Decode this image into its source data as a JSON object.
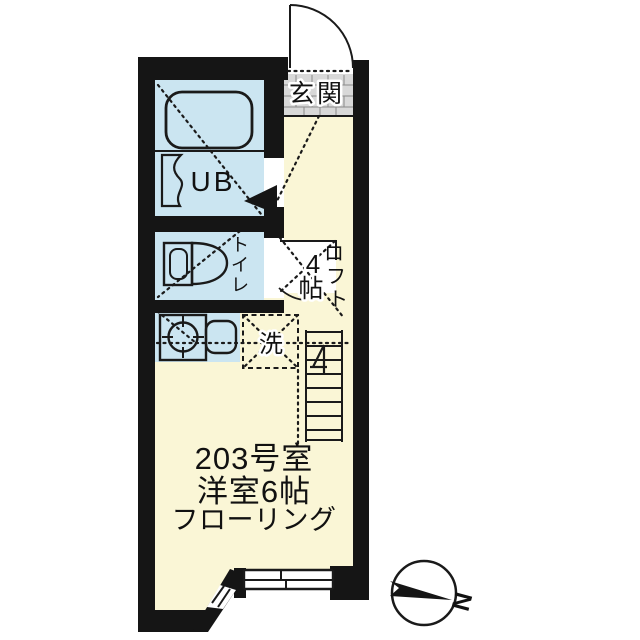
{
  "floorplan": {
    "title": "203号室 間取り図",
    "labels": {
      "entrance": "玄関",
      "unit_bath": "UB",
      "toilet": "トイレ",
      "toilet_chars": [
        "ト",
        "イ",
        "レ"
      ],
      "laundry": "洗",
      "loft": "ロフト",
      "loft_chars": [
        "ロ",
        "フ",
        "ト"
      ],
      "loft_size": "4帖",
      "loft_size_digit": "4",
      "loft_size_unit": "帖",
      "room_number": "203号室",
      "room_type": "洋室6帖",
      "flooring": "フローリング",
      "compass_north": "N"
    },
    "colors": {
      "floor": "#faf6d6",
      "wet_area": "#cbe5f1",
      "entrance_tile": "#d8d8d8",
      "wall": "#151515",
      "background": "#ffffff"
    }
  }
}
